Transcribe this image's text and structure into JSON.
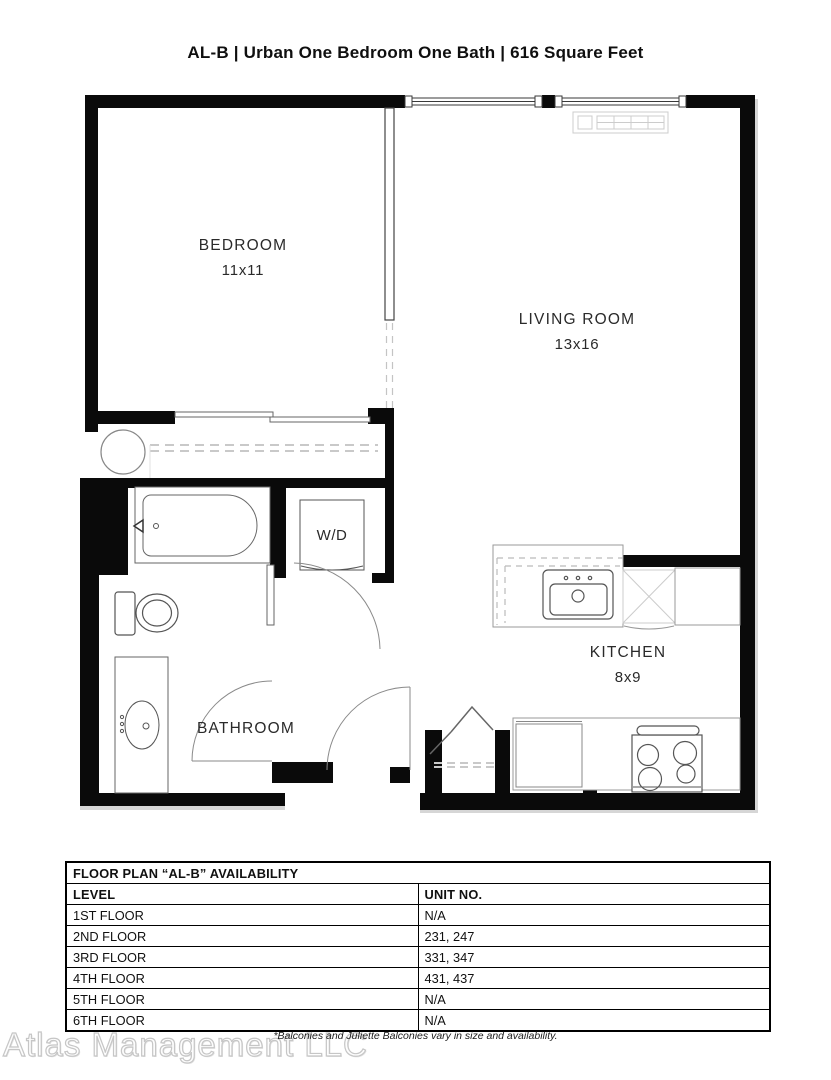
{
  "page": {
    "title": "AL-B | Urban One Bedroom One Bath | 616 Square Feet"
  },
  "floor_plan": {
    "rooms": [
      {
        "name": "BEDROOM",
        "dims": "11x11"
      },
      {
        "name": "LIVING ROOM",
        "dims": "13x16"
      },
      {
        "name": "KITCHEN",
        "dims": "8x9"
      },
      {
        "name": "BATHROOM",
        "dims": ""
      },
      {
        "name": "W/D",
        "dims": ""
      }
    ],
    "fixtures": [
      "bathtub",
      "toilet",
      "vanity-sink",
      "washer-dryer",
      "kitchen-sink",
      "dishwasher",
      "refrigerator",
      "stove",
      "closet-rod",
      "bifold-closet-doors",
      "heater-vent",
      "window",
      "door-swing"
    ],
    "colors": {
      "wall": "#0a0a0a",
      "fixture_line": "#555555",
      "counter_line": "#999999",
      "dashed_line": "#c4c4c4",
      "shadow": "#d6d6d6"
    }
  },
  "availability_table": {
    "title": "FLOOR PLAN “AL-B” AVAILABILITY",
    "columns": [
      "LEVEL",
      "UNIT NO."
    ],
    "rows": [
      [
        "1ST FLOOR",
        "N/A"
      ],
      [
        "2ND FLOOR",
        "231, 247"
      ],
      [
        "3RD FLOOR",
        "331, 347"
      ],
      [
        "4TH FLOOR",
        "431, 437"
      ],
      [
        "5TH FLOOR",
        "N/A"
      ],
      [
        "6TH FLOOR",
        "N/A"
      ]
    ]
  },
  "footer": {
    "note": "*Balconies and Juliette Balconies vary in size and availability.",
    "watermark": "Atlas Management LLC"
  }
}
